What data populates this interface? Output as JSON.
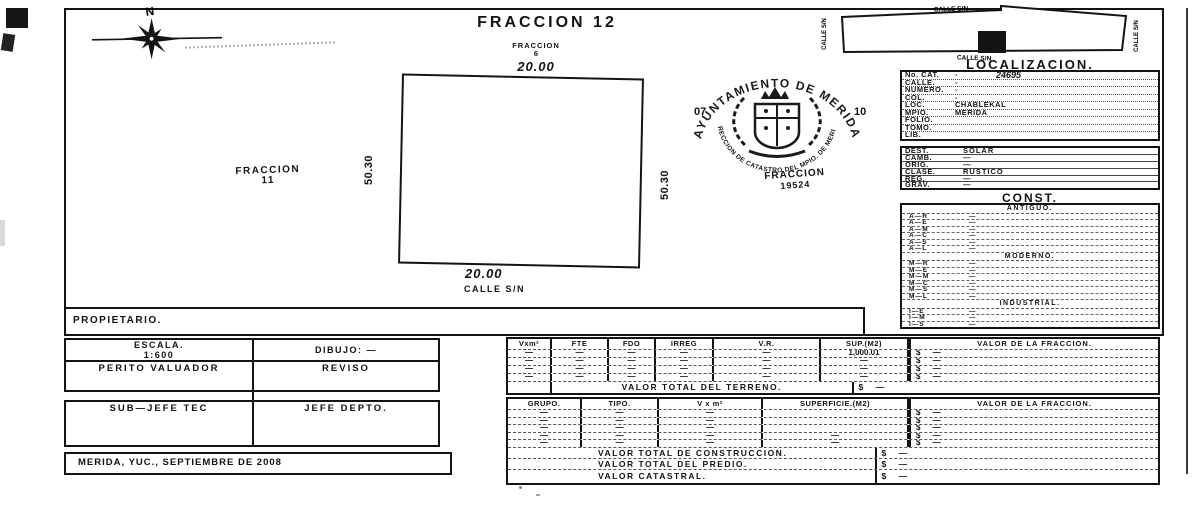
{
  "compass": {
    "north_label": "N"
  },
  "title": "FRACCION 12",
  "plot": {
    "north_neighbor_line1": "FRACCION",
    "north_neighbor_line2": "6",
    "north_dim": "20.00",
    "west_dim": "50.30",
    "east_dim": "50.30",
    "south_dim": "20.00",
    "south_street": "CALLE S/N",
    "west_neighbor_line1": "FRACCION",
    "west_neighbor_line2": "11",
    "parcel_label_line1": "FRACCION",
    "parcel_label_line2": "19524"
  },
  "seal": {
    "arc_top": "AYUNTAMIENTO DE MERIDA",
    "arc_bottom": "DIRECCION DE CATASTRO DEL MPIO. DE MERIDA",
    "left_number": "07",
    "right_number": "10"
  },
  "minimap": {
    "street_top": "CALLE S/N",
    "street_bottom": "CALLE S/N",
    "street_left": "CALLE S/N",
    "street_right": "CALLE S/N"
  },
  "localizacion": {
    "title": "LOCALIZACION.",
    "rows": [
      {
        "label": "No. CAT.",
        "value": "-",
        "value2": "24695"
      },
      {
        "label": "CALLE.",
        "value": "-"
      },
      {
        "label": "NUMERO.",
        "value": "-"
      },
      {
        "label": "COL.",
        "value": "-"
      },
      {
        "label": "LOC.",
        "value": "CHABLEKAL"
      },
      {
        "label": "MPIO.",
        "value": "MERIDA"
      },
      {
        "label": "FOLIO.",
        "value": ""
      },
      {
        "label": "TOMO.",
        "value": ""
      },
      {
        "label": "LIB.",
        "value": ""
      }
    ]
  },
  "destino": {
    "rows": [
      {
        "label": "DEST.",
        "value": "SOLAR"
      },
      {
        "label": "CAMB.",
        "value": "—"
      },
      {
        "label": "ORIG.",
        "value": "—"
      },
      {
        "label": "CLASE.",
        "value": "RUSTICO"
      },
      {
        "label": "REG.",
        "value": "—"
      },
      {
        "label": "GRAV.",
        "value": "—"
      }
    ]
  },
  "construcciones": {
    "title": "CONST.",
    "sections": [
      {
        "title": "ANTIGUO.",
        "rows": [
          {
            "label": "A—R",
            "value": "—"
          },
          {
            "label": "A—E",
            "value": "—"
          },
          {
            "label": "A—M",
            "value": "—"
          },
          {
            "label": "A—C",
            "value": "—"
          },
          {
            "label": "A—S",
            "value": "—"
          },
          {
            "label": "A—L",
            "value": "—"
          }
        ]
      },
      {
        "title": "MODERNO.",
        "rows": [
          {
            "label": "M—R",
            "value": "—"
          },
          {
            "label": "M—E",
            "value": "—"
          },
          {
            "label": "M—M",
            "value": "—"
          },
          {
            "label": "M—C",
            "value": "—"
          },
          {
            "label": "M—S",
            "value": "—"
          },
          {
            "label": "M—L",
            "value": "—"
          }
        ]
      },
      {
        "title": "INDUSTRIAL.",
        "rows": [
          {
            "label": "I—E",
            "value": "—"
          },
          {
            "label": "I—M",
            "value": "—"
          },
          {
            "label": "I—S",
            "value": "—"
          }
        ]
      }
    ]
  },
  "propietario_label": "PROPIETARIO.",
  "escala_box": {
    "escala_label": "ESCALA.",
    "escala_value": "1:600",
    "dibujo_label": "DIBUJO: —",
    "perito_label": "PERITO VALUADOR",
    "reviso_label": "REVISO"
  },
  "firmas_box": {
    "subjefe_label": "SUB—JEFE TEC",
    "jefe_label": "JEFE DEPTO."
  },
  "fecha": "MERIDA, YUC., SEPTIEMBRE DE 2008",
  "terreno_table": {
    "headers": [
      "Vxm²",
      "FTE",
      "FDO",
      "IRREG",
      "V.R.",
      "SUP.(M2)"
    ],
    "valor_header": "VALOR DE LA FRACCION.",
    "rows": [
      {
        "cells": [
          "—",
          "—",
          "—",
          "—",
          "—",
          "1,000.01"
        ],
        "valor": "$ —"
      },
      {
        "cells": [
          "—",
          "—",
          "—",
          "—",
          "—",
          "—"
        ],
        "valor": "$ —"
      },
      {
        "cells": [
          "—",
          "—",
          "—",
          "—",
          "—",
          "—"
        ],
        "valor": "$ —"
      },
      {
        "cells": [
          "—",
          "—",
          "—",
          "—",
          "—",
          "—"
        ],
        "valor": "$ —"
      }
    ],
    "total_label": "VALOR TOTAL DEL TERRENO.",
    "total_valor": "$ —"
  },
  "construccion_table": {
    "headers": [
      "GRUPO.",
      "TIPO.",
      "V x m²",
      "SUPERFICIE.(M2)"
    ],
    "valor_header": "VALOR DE LA FRACCION.",
    "rows": [
      {
        "cells": [
          "—",
          "—",
          "—",
          ""
        ],
        "valor": "$ —"
      },
      {
        "cells": [
          "—",
          "—",
          "—",
          ""
        ],
        "valor": "$ —"
      },
      {
        "cells": [
          "—",
          "—",
          "—",
          ""
        ],
        "valor": "$ —"
      },
      {
        "cells": [
          "—",
          "—",
          "—",
          "—"
        ],
        "valor": "$ —"
      },
      {
        "cells": [
          "—",
          "—",
          "—",
          "—"
        ],
        "valor": "$ —"
      }
    ],
    "footer_rows": [
      {
        "label": "VALOR TOTAL DE CONSTRUCCION.",
        "valor": "$ —"
      },
      {
        "label": "VALOR TOTAL DEL PREDIO.",
        "valor": "$ —"
      },
      {
        "label": "VALOR CATASTRAL.",
        "valor": "$ —"
      }
    ]
  }
}
